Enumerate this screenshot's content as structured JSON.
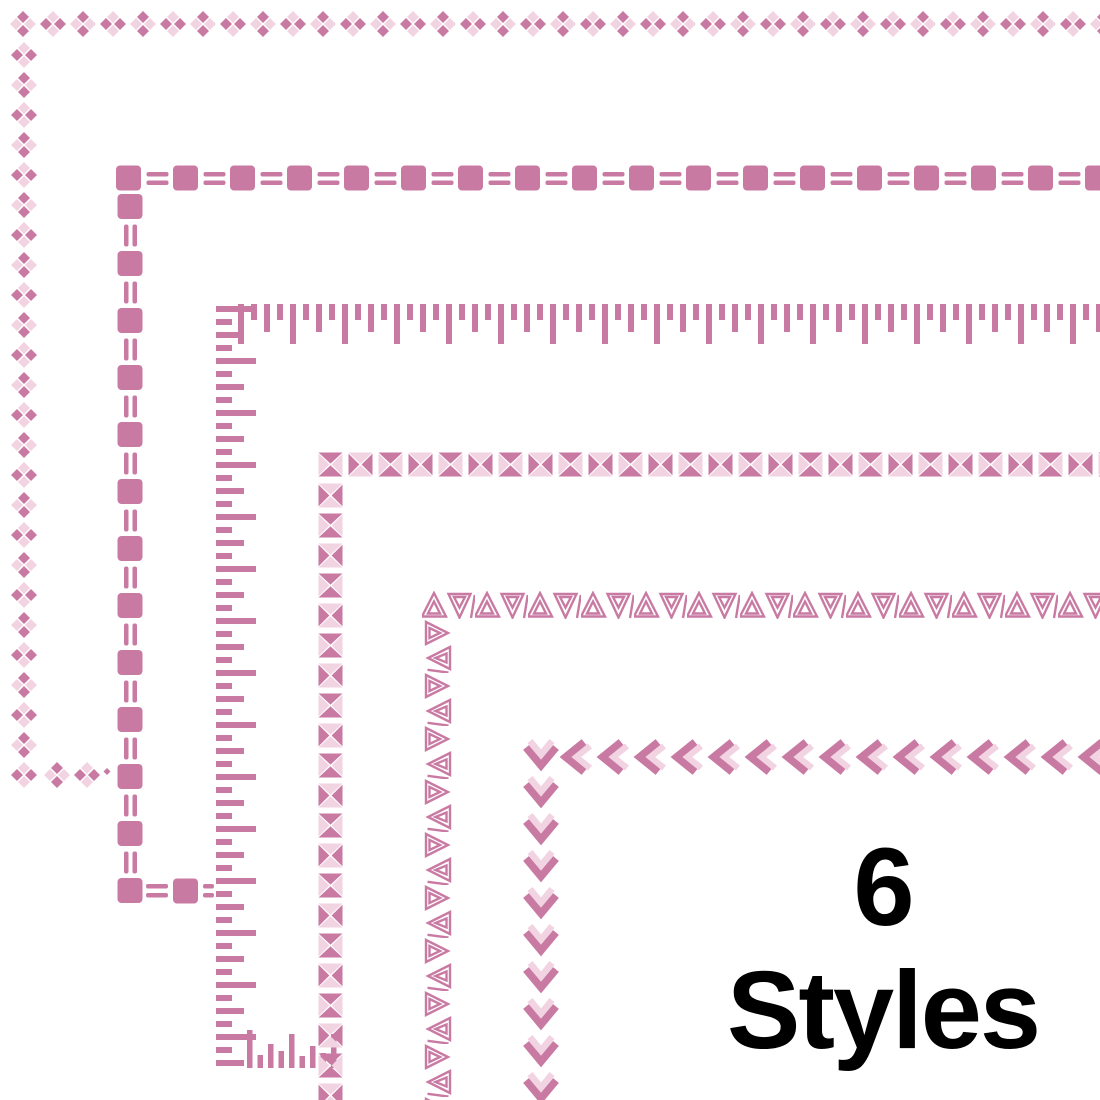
{
  "caption": {
    "line1": "6",
    "line2": "Styles"
  },
  "colors": {
    "dark_pink": "#c97aa3",
    "light_pink": "#f1d3e2",
    "background": "#ffffff",
    "caption_text": "#000000"
  },
  "border_styles": [
    {
      "index": 1,
      "name": "diamond-cluster-border",
      "description": "Clusters of four small diamonds alternating dark and light pink"
    },
    {
      "index": 2,
      "name": "square-double-dash-border",
      "description": "Rounded pink squares separated by double dashes"
    },
    {
      "index": 3,
      "name": "ruler-tick-border",
      "description": "Ruler-style tick bars of alternating long, short and medium length"
    },
    {
      "index": 4,
      "name": "bowtie-square-border",
      "description": "Squares split into four triangles with alternating dark and light pairs"
    },
    {
      "index": 5,
      "name": "triangle-outline-border",
      "description": "Concentric outlined triangles alternating up and down separated by slashes"
    },
    {
      "index": 6,
      "name": "double-chevron-border",
      "description": "Thick dark chevrons with nested light chevrons"
    }
  ]
}
